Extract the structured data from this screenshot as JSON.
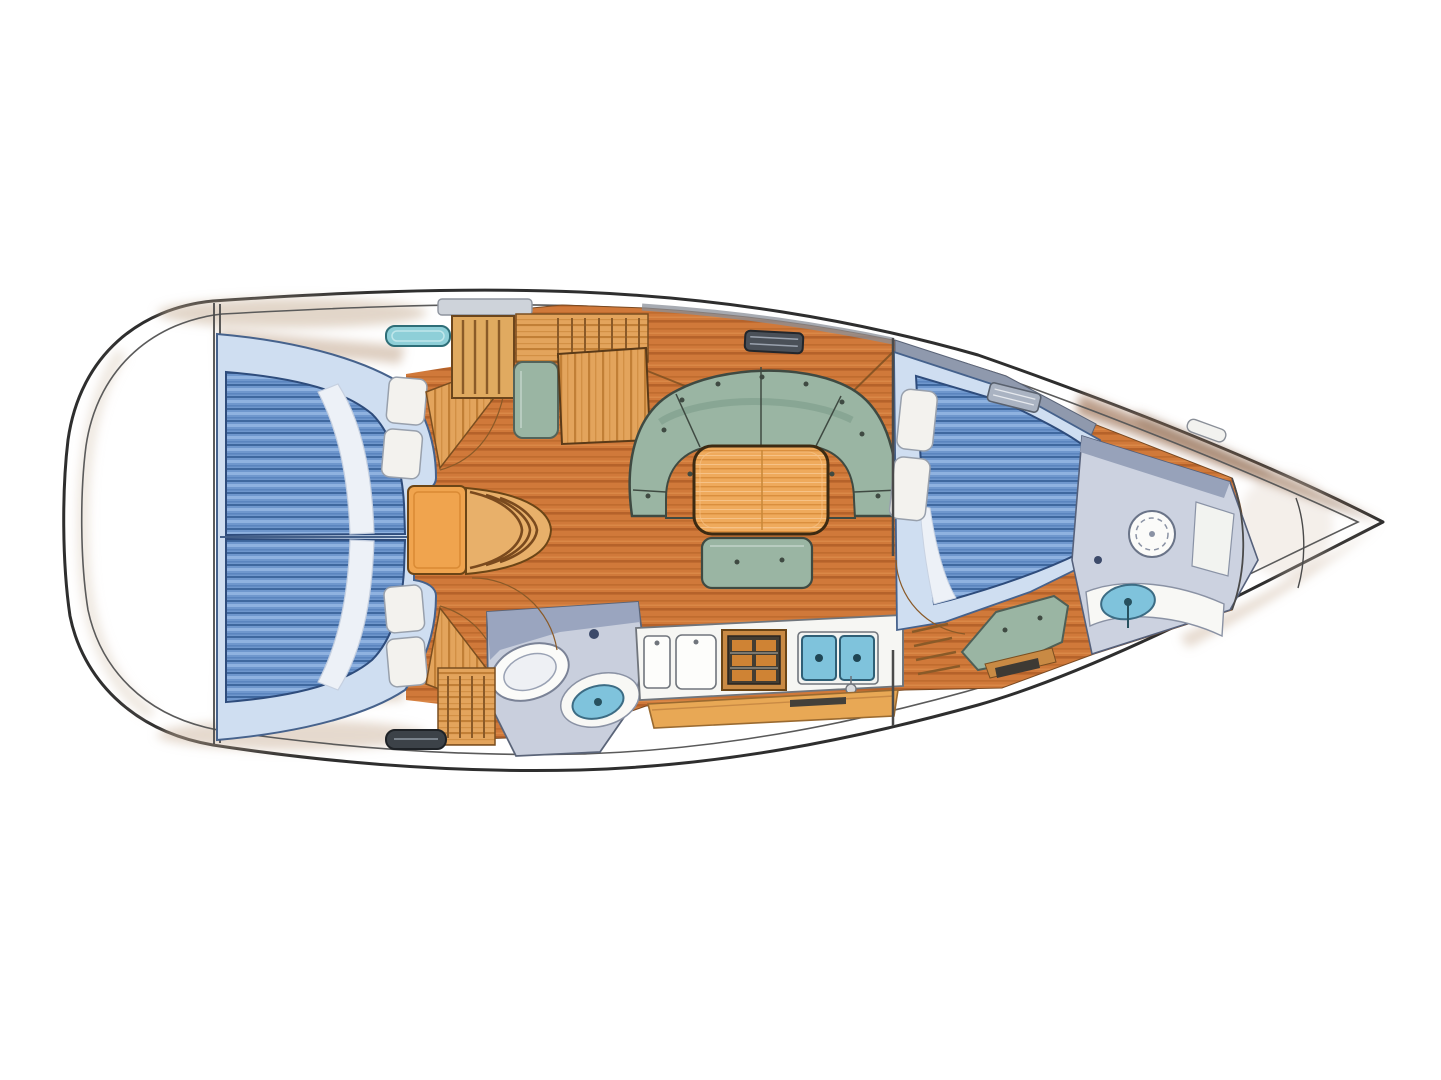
{
  "page": {
    "background": "#ffffff",
    "description": "Hand-drawn top-down interior floor plan of a sailing yacht, bow pointing right: two aft double cabins with blue striped berths, companionway steps, navigation station with chair, U-shaped green salon settee around a wood table, linear galley with stove and twin sinks, aft head with toilet and washbasin, forward double cabin with blue striped berth and green seat, forward head, and bow anchor locker."
  },
  "palette": {
    "hull_outline": "#2e2e2e",
    "inner_deck_line": "#5a5a5a",
    "deck_tan": "#cbb49d",
    "deck_tan_deep": "#c6ae96",
    "bow_brown": "#b2917a",
    "bow_brown_dark": "#8d6b52",
    "floor_wood": "#d0793a",
    "floor_wood_dark": "#b5622a",
    "cabinet_wood": "#e3a45c",
    "cabinet_wood_dark": "#c17f36",
    "table_wood": "#efaa5c",
    "table_grain": "#da8f3e",
    "chair_wood": "#f0a44e",
    "upholstery_green": "#9ab5a3",
    "upholstery_green_dark": "#7d9c8a",
    "upholstery_outline": "#3f4a42",
    "mattress_blue": "#6f97cd",
    "mattress_stripe_light": "#8fb2e0",
    "mattress_stripe_dark": "#3f689f",
    "mattress_outline": "#2e4c7c",
    "bed_platform": "#cfdef1",
    "pillow": "#f3f2ee",
    "head_wall_gray": "#9aa5bf",
    "head_floor_gray": "#ccd2e0",
    "fixture_white": "#fbfbf9",
    "sink_blue": "#7fc3dc",
    "hatch_teal": "#8ecfd8",
    "hatch_dark": "#3c4248",
    "stove_dark": "#433d33"
  },
  "regions": [
    "stern-lazarette",
    "aft-cabin-port",
    "aft-cabin-starboard",
    "companionway-steps",
    "navigation-station",
    "aft-head",
    "salon",
    "galley",
    "forward-cabin",
    "forward-head",
    "bow-anchor-locker"
  ]
}
